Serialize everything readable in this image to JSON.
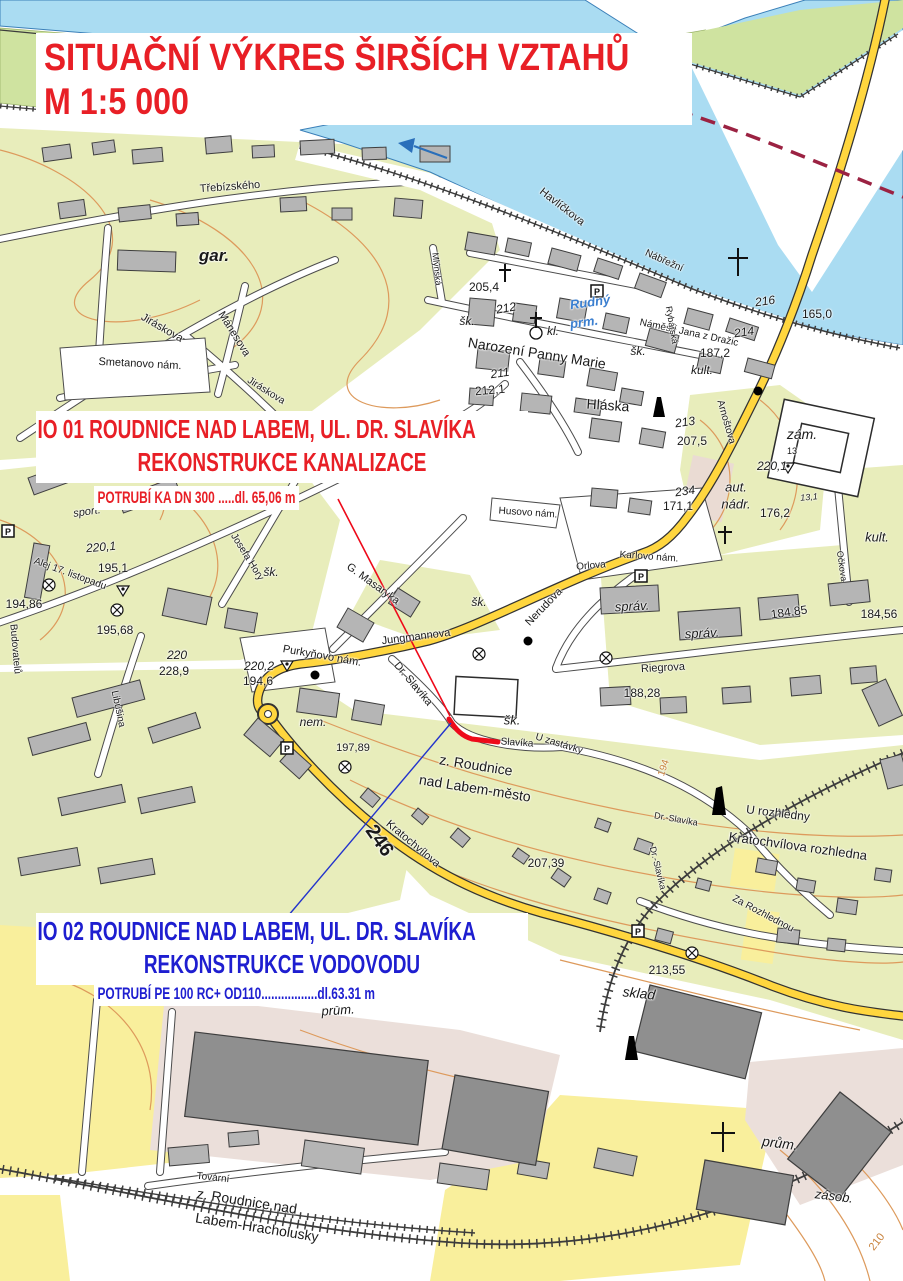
{
  "document": {
    "title_line1": "SITUAČNÍ VÝKRES ŠIRŠÍCH VZTAHŮ",
    "title_line2": "M 1:5 000",
    "title_color": "#e81f26"
  },
  "annotations": {
    "io01": {
      "line1": "IO 01 ROUDNICE NAD LABEM, UL. DR. SLAVÍKA",
      "line2": "REKONSTRUKCE KANALIZACE",
      "pipe_note": "POTRUBÍ KA DN 300  .....dl. 65,06 m",
      "color": "#e81f26"
    },
    "io02": {
      "line1": "IO 02 ROUDNICE NAD LABEM, UL. DR. SLAVÍKA",
      "line2": "REKONSTRUKCE VODOVODU",
      "pipe_note": "POTRUBÍ PE 100 RC+ OD110.................dl.63.31 m",
      "color": "#1e1ed0"
    }
  },
  "map": {
    "colors": {
      "water": "#aadcf2",
      "island_green": "#cfe3a0",
      "vegetation": "#e8edbb",
      "field": "#f9ef9c",
      "industrial": "#ebdfda",
      "road_major": "#ffd63e",
      "contour": "#dd9a5c",
      "pipeline_kanalizace": "#ee0a1a",
      "pipeline_vodovod": "#2233cc",
      "boundary": "#9b2242"
    },
    "labels": [
      {
        "t": "Třebízského",
        "x": 230,
        "y": 187,
        "r": -4,
        "s": 11
      },
      {
        "t": "Havlíčkova",
        "x": 562,
        "y": 207,
        "r": 38,
        "s": 11
      },
      {
        "t": "gar.",
        "x": 214,
        "y": 256,
        "s": 17,
        "i": 1,
        "b": 1
      },
      {
        "t": "Jiráskova",
        "x": 162,
        "y": 328,
        "r": 30,
        "s": 11
      },
      {
        "t": "Mánesova",
        "x": 234,
        "y": 334,
        "r": 58,
        "s": 11
      },
      {
        "t": "Smetanovo nám.",
        "x": 140,
        "y": 364,
        "r": 3,
        "s": 11
      },
      {
        "t": "Jiráskova",
        "x": 266,
        "y": 391,
        "r": 32,
        "s": 10
      },
      {
        "t": "Alej 17. listopadu",
        "x": 70,
        "y": 574,
        "r": 20,
        "s": 10
      },
      {
        "t": "Josefa Hory",
        "x": 247,
        "y": 557,
        "r": 58,
        "s": 10
      },
      {
        "t": "Libušina",
        "x": 118,
        "y": 709,
        "r": 78,
        "s": 10
      },
      {
        "t": "Budovatelů",
        "x": 15,
        "y": 649,
        "r": 85,
        "s": 10
      },
      {
        "t": "Purkyňovo nám.",
        "x": 322,
        "y": 656,
        "r": 10,
        "s": 11
      },
      {
        "t": "Jungmannova",
        "x": 416,
        "y": 637,
        "r": -7,
        "s": 11
      },
      {
        "t": "Nerudova",
        "x": 544,
        "y": 607,
        "r": -46,
        "s": 11
      },
      {
        "t": "Orlova",
        "x": 591,
        "y": 566,
        "r": -5,
        "s": 10
      },
      {
        "t": "Riegrova",
        "x": 663,
        "y": 668,
        "r": -3,
        "s": 11
      },
      {
        "t": "G. Masaryka",
        "x": 373,
        "y": 584,
        "r": 36,
        "s": 11
      },
      {
        "t": "Dr. Slavíka",
        "x": 413,
        "y": 684,
        "r": 50,
        "s": 11
      },
      {
        "t": "Dr.-Slavíka",
        "x": 676,
        "y": 819,
        "r": 10,
        "s": 9
      },
      {
        "t": "Dr.-Slavíka",
        "x": 658,
        "y": 868,
        "r": 76,
        "s": 9
      },
      {
        "t": "Slavíka",
        "x": 517,
        "y": 743,
        "r": 4,
        "s": 10
      },
      {
        "t": "U zastávky",
        "x": 559,
        "y": 744,
        "r": 17,
        "s": 10
      },
      {
        "t": "Kratochvílova",
        "x": 413,
        "y": 844,
        "r": 40,
        "s": 11
      },
      {
        "t": "Karlovo nám.",
        "x": 649,
        "y": 557,
        "r": 4,
        "s": 10
      },
      {
        "t": "Arnoštova",
        "x": 726,
        "y": 422,
        "r": 74,
        "s": 10
      },
      {
        "t": "Očkova",
        "x": 842,
        "y": 566,
        "r": 82,
        "s": 9
      },
      {
        "t": "Náměstí Jana z Dražic",
        "x": 689,
        "y": 333,
        "r": 12,
        "s": 10
      },
      {
        "t": "Nábřežní",
        "x": 664,
        "y": 261,
        "r": 24,
        "s": 10
      },
      {
        "t": "Rybářská",
        "x": 672,
        "y": 325,
        "r": 80,
        "s": 9
      },
      {
        "t": "Mlýnská",
        "x": 437,
        "y": 269,
        "r": 84,
        "s": 9
      },
      {
        "t": "Hláska",
        "x": 608,
        "y": 405,
        "r": 4,
        "s": 14
      },
      {
        "t": "Narození Panny Marie",
        "x": 537,
        "y": 353,
        "r": 9,
        "s": 14
      },
      {
        "t": "Rudný",
        "x": 590,
        "y": 302,
        "r": -8,
        "s": 13,
        "i": 1,
        "b": 1,
        "c": "#3b7fd0"
      },
      {
        "t": "prm.",
        "x": 584,
        "y": 322,
        "r": -8,
        "s": 13,
        "i": 1,
        "b": 1,
        "c": "#3b7fd0"
      },
      {
        "t": "z. Roudnice",
        "x": 476,
        "y": 765,
        "r": 9,
        "s": 14
      },
      {
        "t": "nad Labem-město",
        "x": 475,
        "y": 788,
        "r": 9,
        "s": 14
      },
      {
        "t": "z. Roudnice nad",
        "x": 247,
        "y": 1201,
        "r": 9,
        "s": 14
      },
      {
        "t": "Labem-Hracholusky",
        "x": 257,
        "y": 1227,
        "r": 9,
        "s": 14
      },
      {
        "t": "Tovární",
        "x": 213,
        "y": 1178,
        "r": 6,
        "s": 10
      },
      {
        "t": "U rozhledny",
        "x": 778,
        "y": 813,
        "r": 7,
        "s": 12
      },
      {
        "t": "Kratochvílova rozhledna",
        "x": 798,
        "y": 846,
        "r": 8,
        "s": 13
      },
      {
        "t": "Za Rozhlednou",
        "x": 763,
        "y": 914,
        "r": 28,
        "s": 10
      },
      {
        "t": "sklad",
        "x": 639,
        "y": 993,
        "r": 6,
        "s": 14,
        "i": 1
      },
      {
        "t": "prům.",
        "x": 338,
        "y": 1010,
        "r": -4,
        "s": 13,
        "i": 1
      },
      {
        "t": "prům.",
        "x": 780,
        "y": 1143,
        "r": 7,
        "s": 14,
        "i": 1
      },
      {
        "t": "zásob.",
        "x": 834,
        "y": 1196,
        "r": 7,
        "s": 13,
        "i": 1
      },
      {
        "t": "šk.",
        "x": 467,
        "y": 321,
        "s": 12,
        "i": 1
      },
      {
        "t": "šk.",
        "x": 638,
        "y": 351,
        "s": 12,
        "i": 1
      },
      {
        "t": "šk.",
        "x": 271,
        "y": 572,
        "s": 12,
        "i": 1
      },
      {
        "t": "šk.",
        "x": 479,
        "y": 602,
        "s": 12,
        "i": 1
      },
      {
        "t": "šk.",
        "x": 512,
        "y": 720,
        "s": 13,
        "i": 1
      },
      {
        "t": "kl.",
        "x": 553,
        "y": 331,
        "s": 12,
        "i": 1
      },
      {
        "t": "kult.",
        "x": 702,
        "y": 370,
        "s": 12,
        "i": 1
      },
      {
        "t": "kult.",
        "x": 877,
        "y": 537,
        "s": 13,
        "i": 1
      },
      {
        "t": "zám.",
        "x": 802,
        "y": 434,
        "s": 14,
        "i": 1
      },
      {
        "t": "13",
        "x": 792,
        "y": 451,
        "s": 9
      },
      {
        "t": "aut.",
        "x": 736,
        "y": 487,
        "s": 13,
        "i": 1
      },
      {
        "t": "nádr.",
        "x": 736,
        "y": 504,
        "s": 13,
        "i": 1
      },
      {
        "t": "správ.",
        "x": 632,
        "y": 606,
        "r": -3,
        "s": 13,
        "i": 1
      },
      {
        "t": "správ.",
        "x": 702,
        "y": 633,
        "r": -3,
        "s": 13,
        "i": 1
      },
      {
        "t": "sport.",
        "x": 87,
        "y": 512,
        "r": -8,
        "s": 11,
        "i": 1
      },
      {
        "t": "nem.",
        "x": 313,
        "y": 722,
        "s": 12,
        "i": 1
      },
      {
        "t": "Husovo nám.",
        "x": 528,
        "y": 513,
        "r": 4,
        "s": 10
      },
      {
        "t": "205,4",
        "x": 484,
        "y": 287,
        "s": 12
      },
      {
        "t": "212",
        "x": 506,
        "y": 308,
        "r": -10,
        "s": 12,
        "i": 1
      },
      {
        "t": "211",
        "x": 500,
        "y": 373,
        "r": -8,
        "s": 12,
        "i": 1
      },
      {
        "t": "212,1",
        "x": 490,
        "y": 390,
        "r": -5,
        "s": 12
      },
      {
        "t": "213",
        "x": 685,
        "y": 422,
        "r": -8,
        "s": 12,
        "i": 1
      },
      {
        "t": "207,5",
        "x": 692,
        "y": 441,
        "s": 12
      },
      {
        "t": "220,1",
        "x": 772,
        "y": 466,
        "s": 12,
        "i": 1
      },
      {
        "t": "13,1",
        "x": 809,
        "y": 497,
        "r": -5,
        "s": 9,
        "i": 1
      },
      {
        "t": "176,2",
        "x": 775,
        "y": 513,
        "s": 12
      },
      {
        "t": "234",
        "x": 685,
        "y": 491,
        "r": -8,
        "s": 12,
        "i": 1
      },
      {
        "t": "171,1",
        "x": 678,
        "y": 506,
        "s": 12
      },
      {
        "t": "187,2",
        "x": 715,
        "y": 353,
        "s": 12
      },
      {
        "t": "214",
        "x": 744,
        "y": 332,
        "r": -8,
        "s": 12,
        "i": 1
      },
      {
        "t": "216",
        "x": 765,
        "y": 301,
        "r": -8,
        "s": 12,
        "i": 1
      },
      {
        "t": "165,0",
        "x": 817,
        "y": 314,
        "s": 12
      },
      {
        "t": "184,85",
        "x": 789,
        "y": 612,
        "r": -8,
        "s": 12
      },
      {
        "t": "184,56",
        "x": 879,
        "y": 614,
        "s": 12
      },
      {
        "t": "188,28",
        "x": 642,
        "y": 693,
        "s": 12
      },
      {
        "t": "194",
        "x": 664,
        "y": 768,
        "r": -72,
        "s": 10,
        "c": "#c8823c"
      },
      {
        "t": "220,1",
        "x": 101,
        "y": 547,
        "r": -5,
        "s": 12,
        "i": 1
      },
      {
        "t": "195,1",
        "x": 113,
        "y": 568,
        "s": 12
      },
      {
        "t": "194,86",
        "x": 24,
        "y": 604,
        "s": 12
      },
      {
        "t": "195,68",
        "x": 115,
        "y": 630,
        "s": 12
      },
      {
        "t": "220",
        "x": 177,
        "y": 655,
        "s": 12,
        "i": 1
      },
      {
        "t": "228,9",
        "x": 174,
        "y": 671,
        "s": 12
      },
      {
        "t": "220,2",
        "x": 259,
        "y": 666,
        "s": 12,
        "i": 1
      },
      {
        "t": "194,6",
        "x": 258,
        "y": 681,
        "s": 12
      },
      {
        "t": "197,89",
        "x": 353,
        "y": 748,
        "s": 11
      },
      {
        "t": "207,39",
        "x": 546,
        "y": 863,
        "s": 12
      },
      {
        "t": "213,55",
        "x": 667,
        "y": 970,
        "s": 12
      },
      {
        "t": "246",
        "x": 379,
        "y": 841,
        "r": 55,
        "s": 20,
        "b": 1
      },
      {
        "t": "210",
        "x": 877,
        "y": 1242,
        "r": -52,
        "s": 11,
        "c": "#c8823c"
      }
    ]
  }
}
